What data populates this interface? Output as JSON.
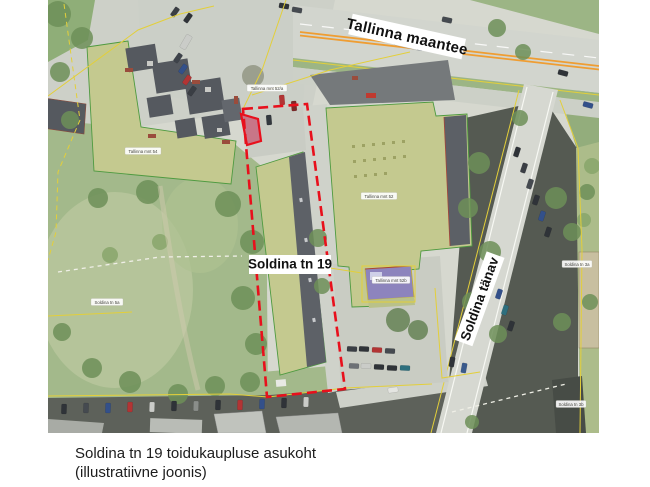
{
  "figure": {
    "caption_line1": "Soldina tn 19 toidukaupluse asukoht",
    "caption_line2": "(illustratiivne joonis)"
  },
  "map": {
    "road_label_main": "Tallinna maantee",
    "road_label_side": "Soldina tänav",
    "site_label": "Soldina tn 19",
    "parcel_labels": {
      "mnt52a": "Tallinna mnt 52/a",
      "mnt54": "Tallinna mnt 54",
      "mnt52": "Tallinna mnt 52",
      "mnt52b": "Tallinna mnt 52b",
      "tn5a": "Soldina tn 5a",
      "tn3a": "Soldina tn 3a",
      "tn3b": "Soldina tn 3b"
    },
    "colors": {
      "highlight_red": "#e8101c",
      "site_fill_red": "#c63056",
      "building_fill": "#c4c98f",
      "building_stroke": "#4e9a40",
      "cadastral_yellow": "#e3cf3a",
      "road_center_orange": "#ef9d32"
    }
  }
}
